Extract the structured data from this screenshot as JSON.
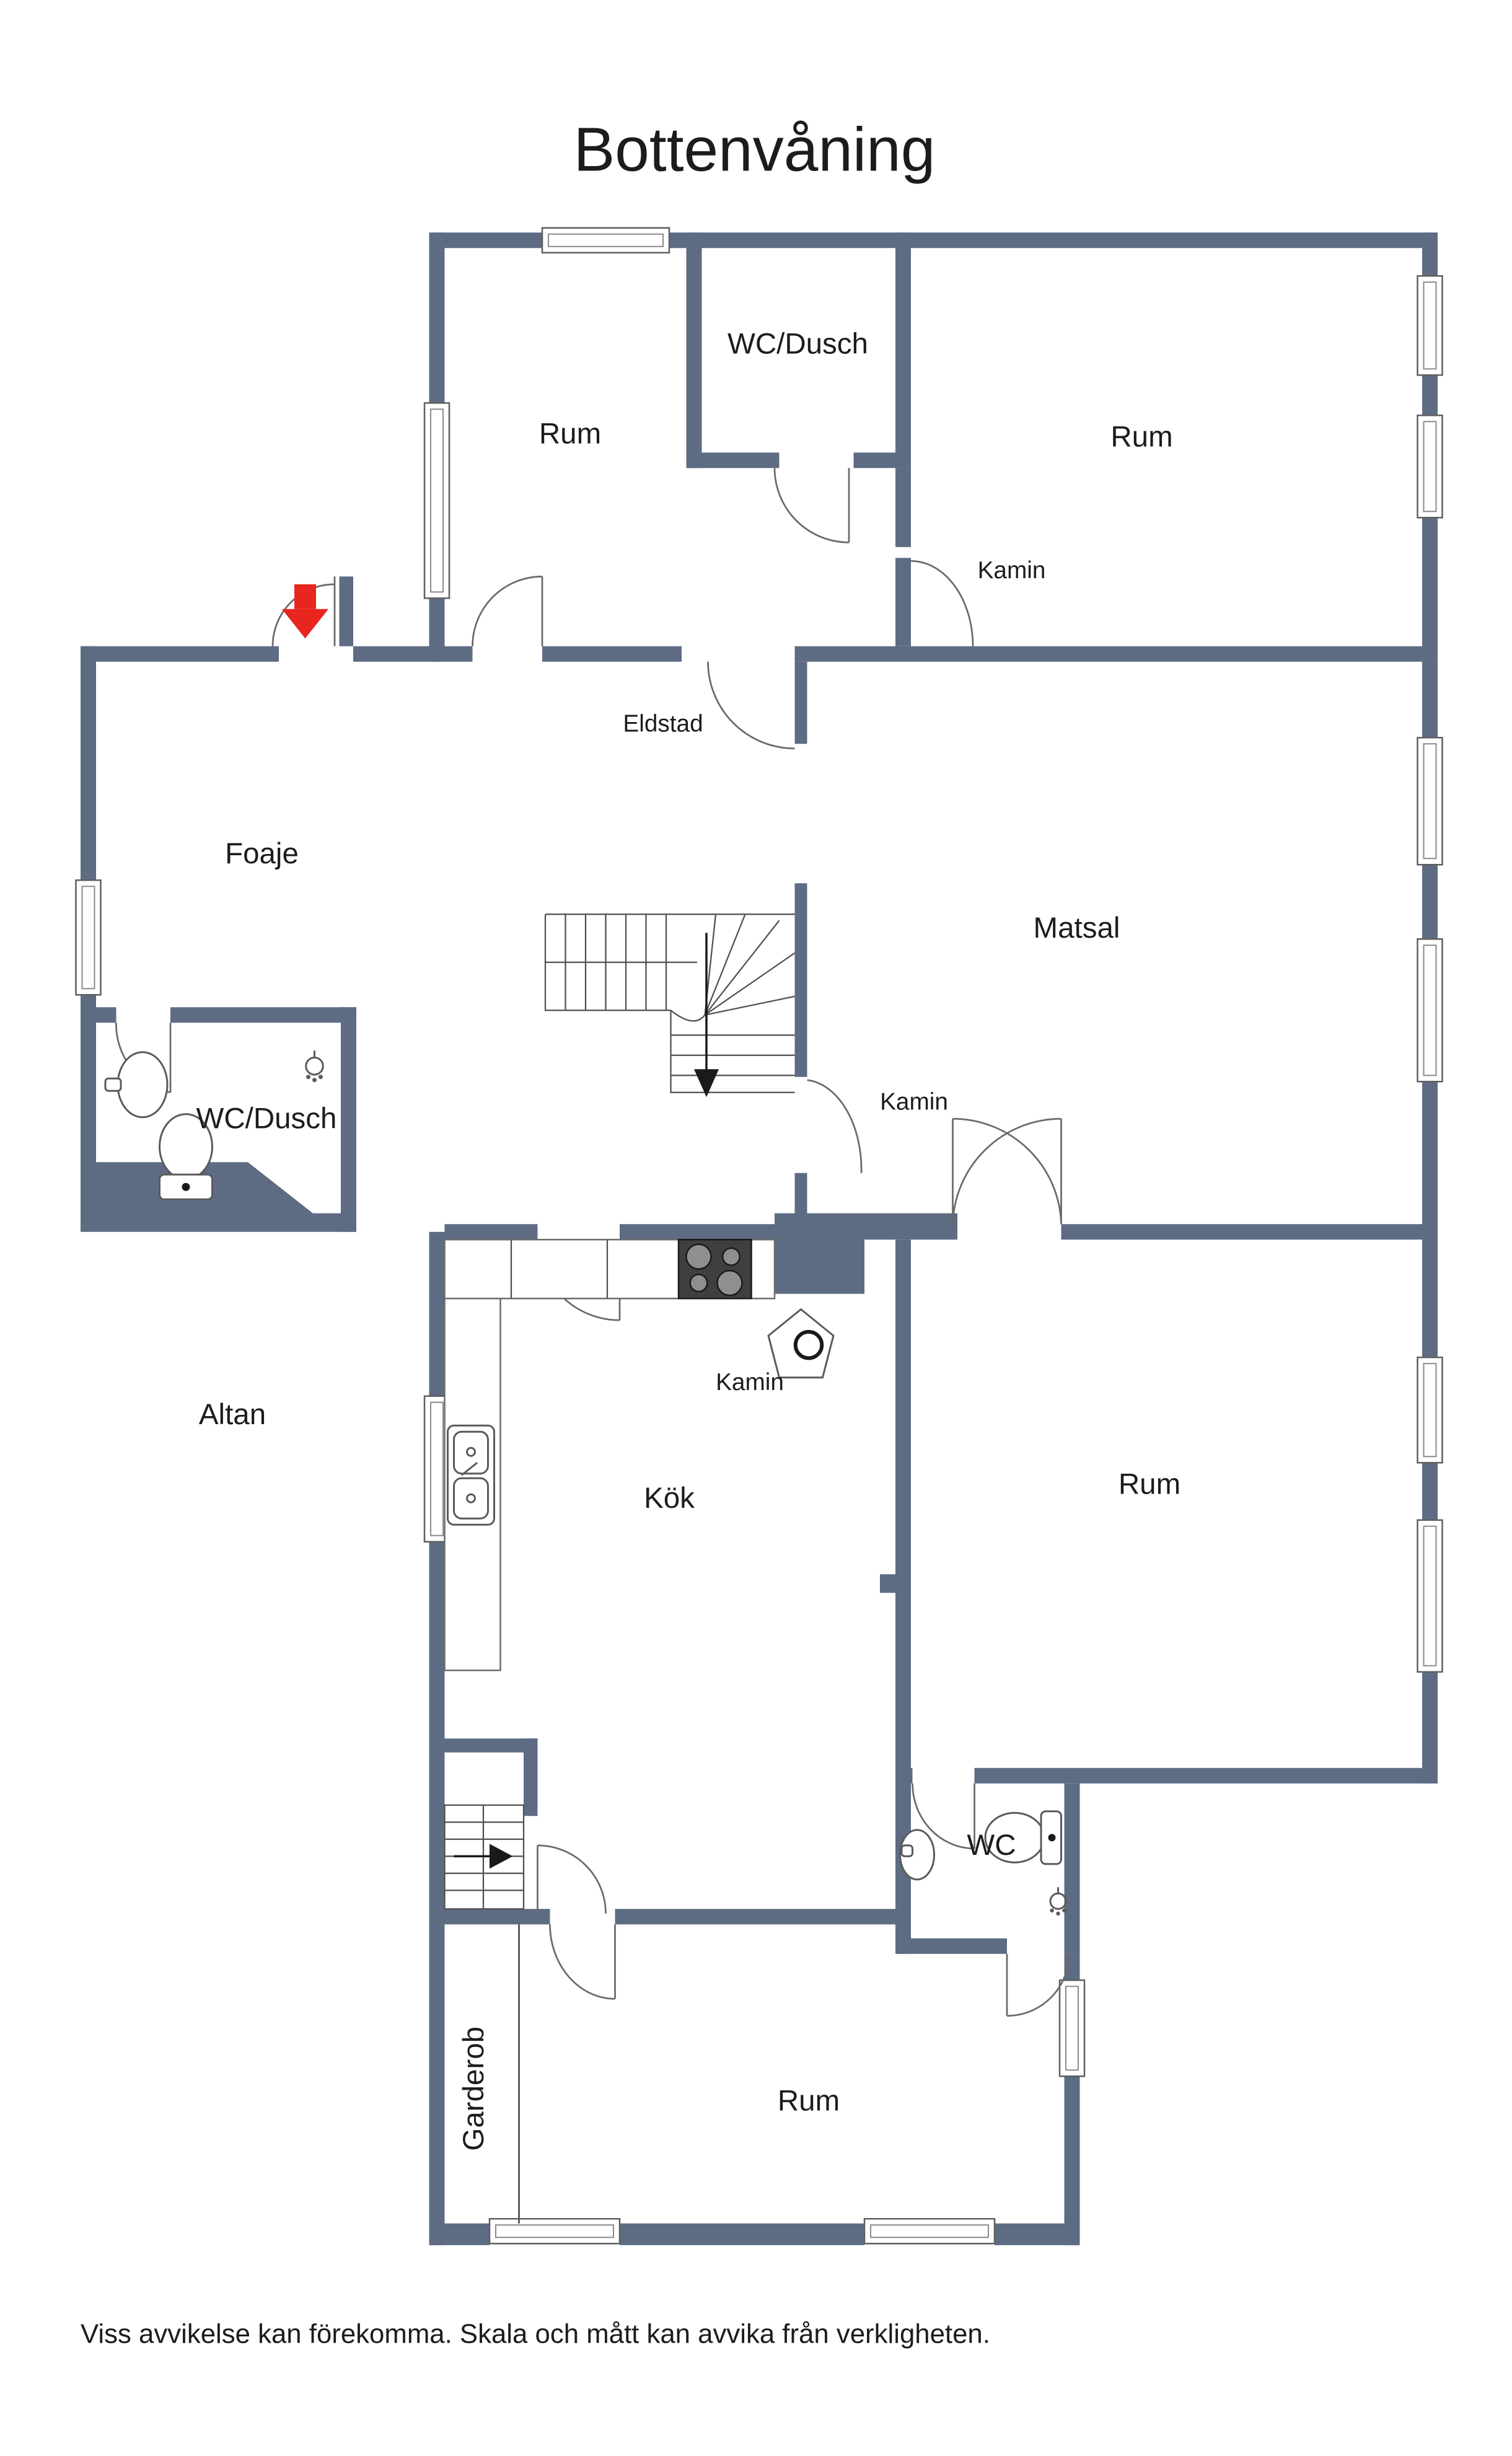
{
  "title": "Bottenvåning",
  "footer": "Viss avvikelse kan förekomma. Skala och mått kan avvika från verkligheten.",
  "colors": {
    "wall": "#5d6c83",
    "entrance_arrow": "#e8251f",
    "stair_arrow": "#1a1a1a",
    "text": "#1c1c1c",
    "stove": "#3f3f3f"
  },
  "rooms": [
    {
      "id": "rum-top-left",
      "label": "Rum"
    },
    {
      "id": "wc-dusch-top",
      "label": "WC/Dusch"
    },
    {
      "id": "rum-top-right",
      "label": "Rum"
    },
    {
      "id": "foaje",
      "label": "Foaje"
    },
    {
      "id": "matsal",
      "label": "Matsal"
    },
    {
      "id": "wc-dusch-left",
      "label": "WC/Dusch"
    },
    {
      "id": "altan",
      "label": "Altan"
    },
    {
      "id": "kok",
      "label": "Kök"
    },
    {
      "id": "rum-right",
      "label": "Rum"
    },
    {
      "id": "wc",
      "label": "WC"
    },
    {
      "id": "garderob",
      "label": "Garderob"
    },
    {
      "id": "rum-bottom",
      "label": "Rum"
    }
  ],
  "annotations": [
    {
      "id": "kamin-top-right",
      "label": "Kamin"
    },
    {
      "id": "eldstad",
      "label": "Eldstad"
    },
    {
      "id": "kamin-stair",
      "label": "Kamin"
    },
    {
      "id": "kamin-kok",
      "label": "Kamin"
    }
  ],
  "icons": [
    "entrance-arrow-icon",
    "stairs-down-arrow-icon",
    "basement-stairs-arrow-icon",
    "toilet-icon",
    "sink-icon",
    "shower-icon",
    "stove-icon",
    "kitchen-sink-icon",
    "chimney-icon"
  ]
}
